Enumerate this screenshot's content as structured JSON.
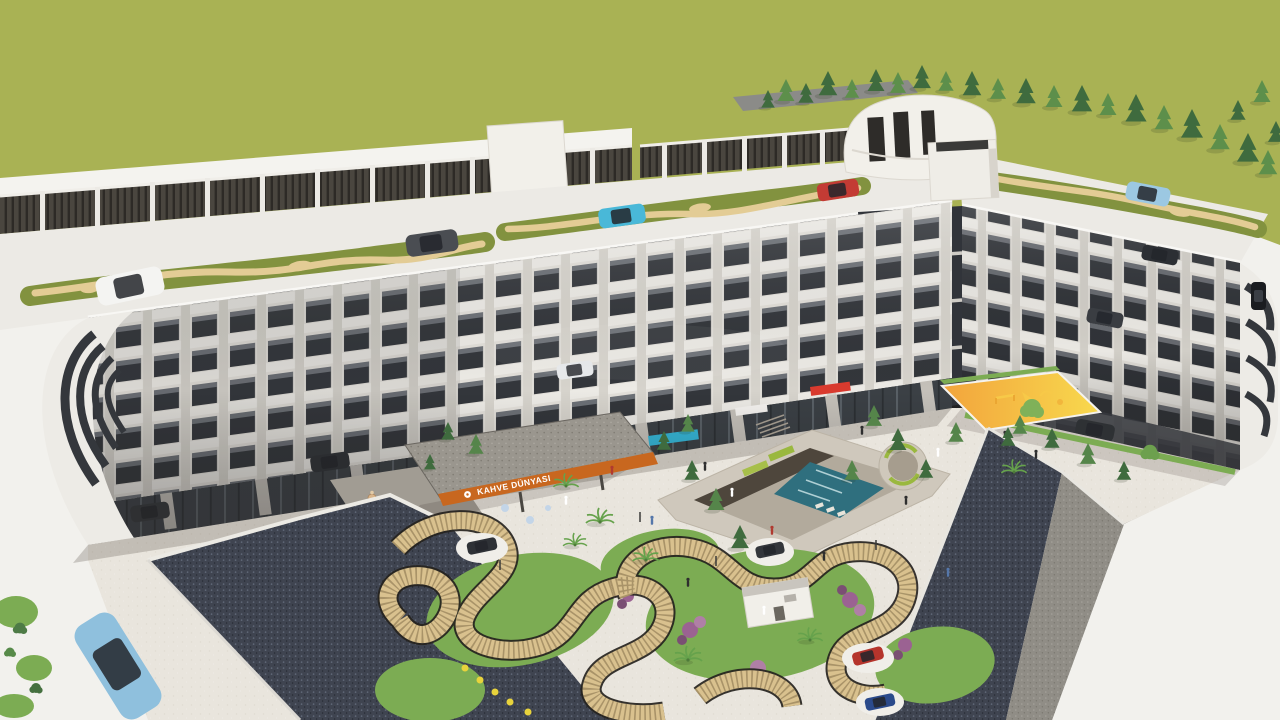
{
  "meta": {
    "type": "architectural-3d-render",
    "title": "Aerial 3D rendering of residential complex with courtyard"
  },
  "scene": {
    "description": "Aerial 3D architectural rendering of a C-shaped white apartment block with rooftop driving/parking deck, dark slatted screen fence, rooftop entrance pavilion, conifer tree line, landscaped inner courtyard with sunken pool plaza, circular seating pit, yellow children's playground, wavy slatted pergola garden with flower beds and palm trees, cafe terrace with orange sign, carports and dark access ramps, cars on roads and decks",
    "signs": {
      "cafe": "KAHVE DÜNYASI"
    },
    "colors": {
      "field": "#a9b254",
      "lawn": "#7cac53",
      "building": "#eceae5",
      "window": "#35373c",
      "fence": "#4a463f",
      "deck_strip": "#82923f",
      "path_tan": "#e3cc95",
      "pergola_tan": "#d9c18e",
      "cafe_orange": "#c8671f",
      "sign_yellow": "#f2d126",
      "sign_cyan": "#35b5d6",
      "sign_red": "#d93a2e",
      "playground_from": "#f2a43c",
      "playground_to": "#f8d94e",
      "water": "#2f6f7e",
      "ramp": "#3f4450",
      "paving": "#e9e5dd",
      "road": "#f2f1ed",
      "car_blue": "#8fc0dd"
    }
  }
}
